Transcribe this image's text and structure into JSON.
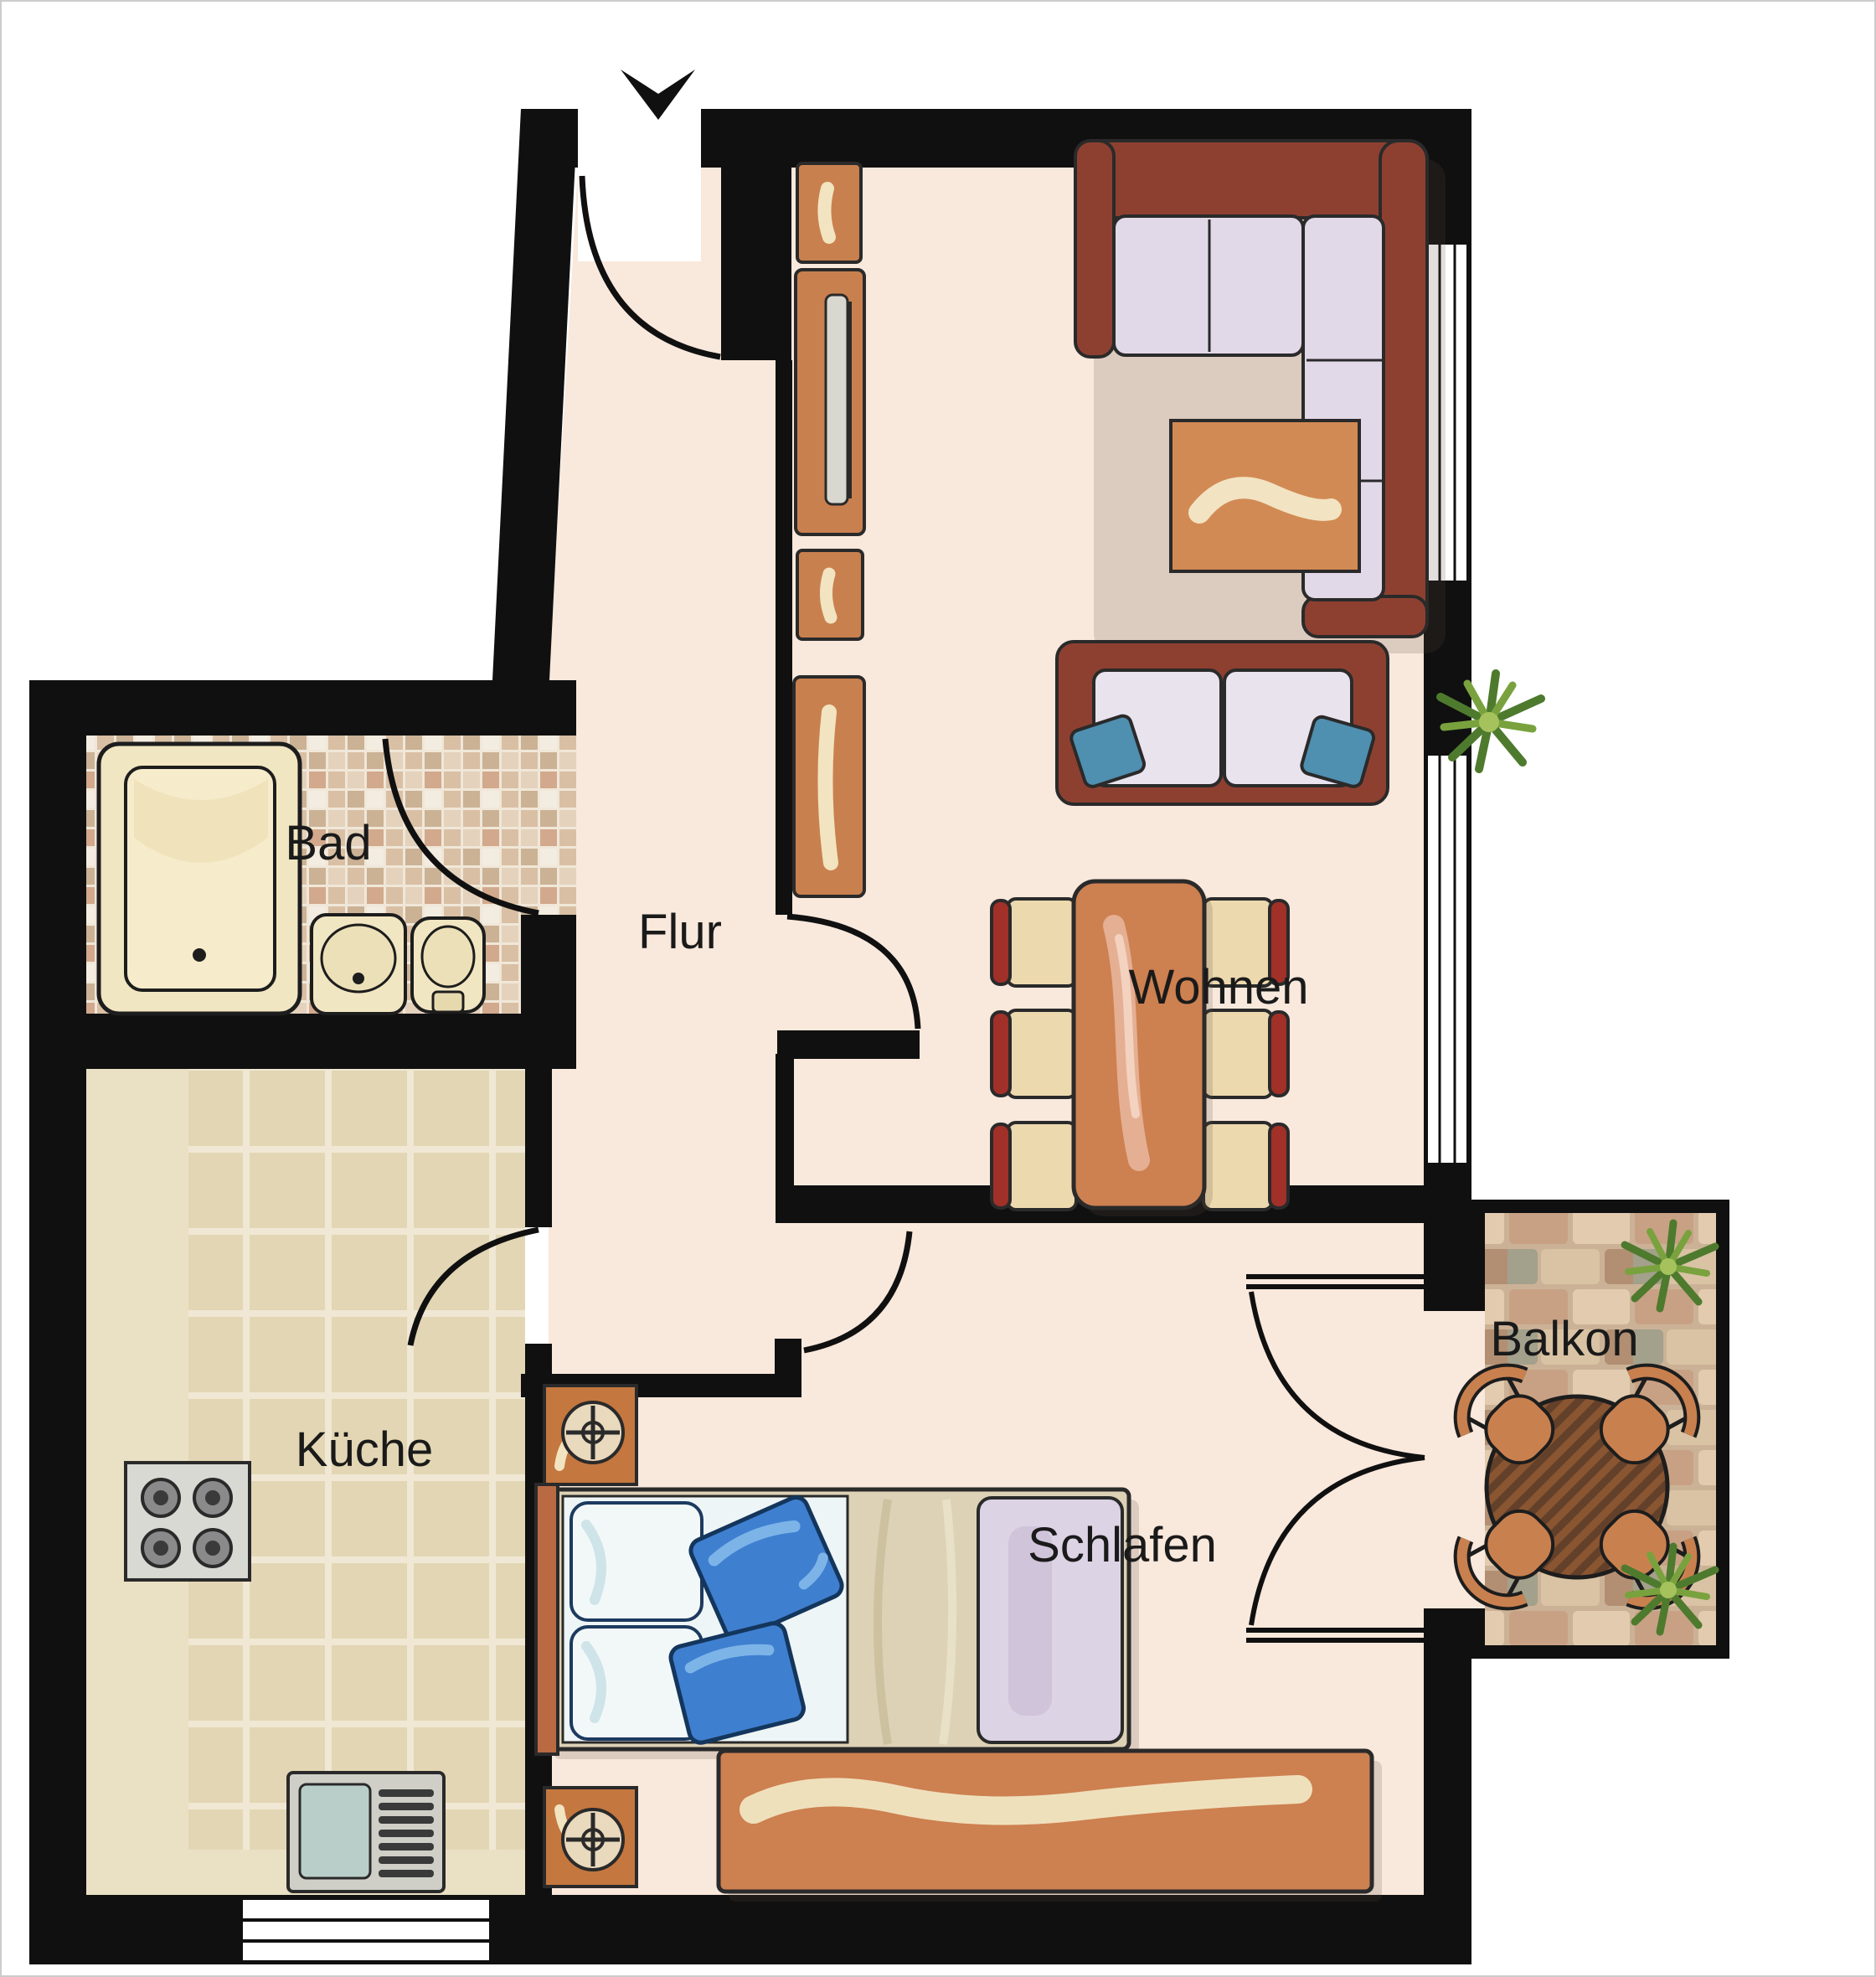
{
  "title": "Apartment floor plan",
  "rooms": {
    "wohnen": {
      "label": "Wohnen"
    },
    "flur": {
      "label": "Flur"
    },
    "bad": {
      "label": "Bad"
    },
    "kueche": {
      "label": "Küche"
    },
    "schlafen": {
      "label": "Schlafen"
    },
    "balkon": {
      "label": "Balkon"
    }
  },
  "icons": {
    "entrance_arrow": "entrance-arrow-icon"
  },
  "colors": {
    "wall": "#101010",
    "room_floor": "#f9e8dc",
    "kitchen_tile": "#e6dabb",
    "kitchen_counter": "#eae1c4",
    "bath_mosaic_base": "#f0e7d8",
    "balcony_brick_base": "#cbb296",
    "furniture_orange": "#c9804f",
    "sofa_frame": "#8e4030",
    "sofa_cushion": "#e2d9e8",
    "pillow_blue": "#3f7fd0",
    "sofa_pillow_teal": "#4f8fb0",
    "dining_chair_red": "#a03028",
    "chair_seat": "#edd9ae",
    "accent_cream": "#f2e4c0",
    "bed_blanket": "#ddd2b6",
    "bed_throw_lavender": "#dcd3e4",
    "fixture_cream": "#f1e6c2",
    "stove_grey": "#d9d9d4",
    "sink_basin": "#b9cec8",
    "plant_green_dark": "#4e7a2e",
    "plant_green_light": "#79a23e"
  }
}
